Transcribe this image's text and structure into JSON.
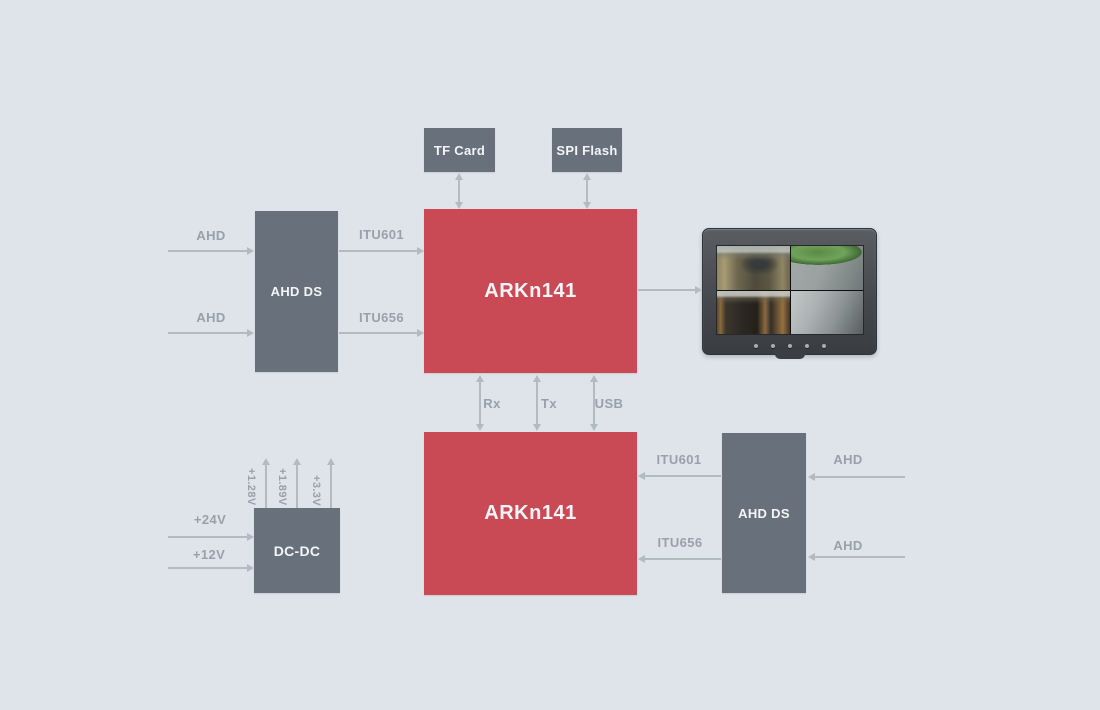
{
  "colors": {
    "background": "#dfe4ea",
    "block_gray": "#68717b",
    "block_red": "#c94a55",
    "block_text": "#f3f5f7",
    "arrow": "#b2bac2",
    "signal_text": "#98a1ab"
  },
  "blocks": {
    "tf_card": {
      "label": "TF Card"
    },
    "spi_flash": {
      "label": "SPI Flash"
    },
    "ahd_ds_left": {
      "label": "AHD DS"
    },
    "arkn141_top": {
      "label": "ARKn141"
    },
    "arkn141_bottom": {
      "label": "ARKn141"
    },
    "ahd_ds_right": {
      "label": "AHD DS"
    },
    "dc_dc": {
      "label": "DC-DC"
    }
  },
  "signals": {
    "ahd_left_top": "AHD",
    "ahd_left_bottom": "AHD",
    "itu601_left": "ITU601",
    "itu656_left": "ITU656",
    "rx": "Rx",
    "tx": "Tx",
    "usb": "USB",
    "itu601_right": "ITU601",
    "itu656_right": "ITU656",
    "ahd_right_top": "AHD",
    "ahd_right_bottom": "AHD",
    "power_in_top": "+24V",
    "power_in_bottom": "+12V",
    "power_rail_1": "+1.28V",
    "power_rail_2": "+1.89V",
    "power_rail_3": "+3.3V"
  }
}
